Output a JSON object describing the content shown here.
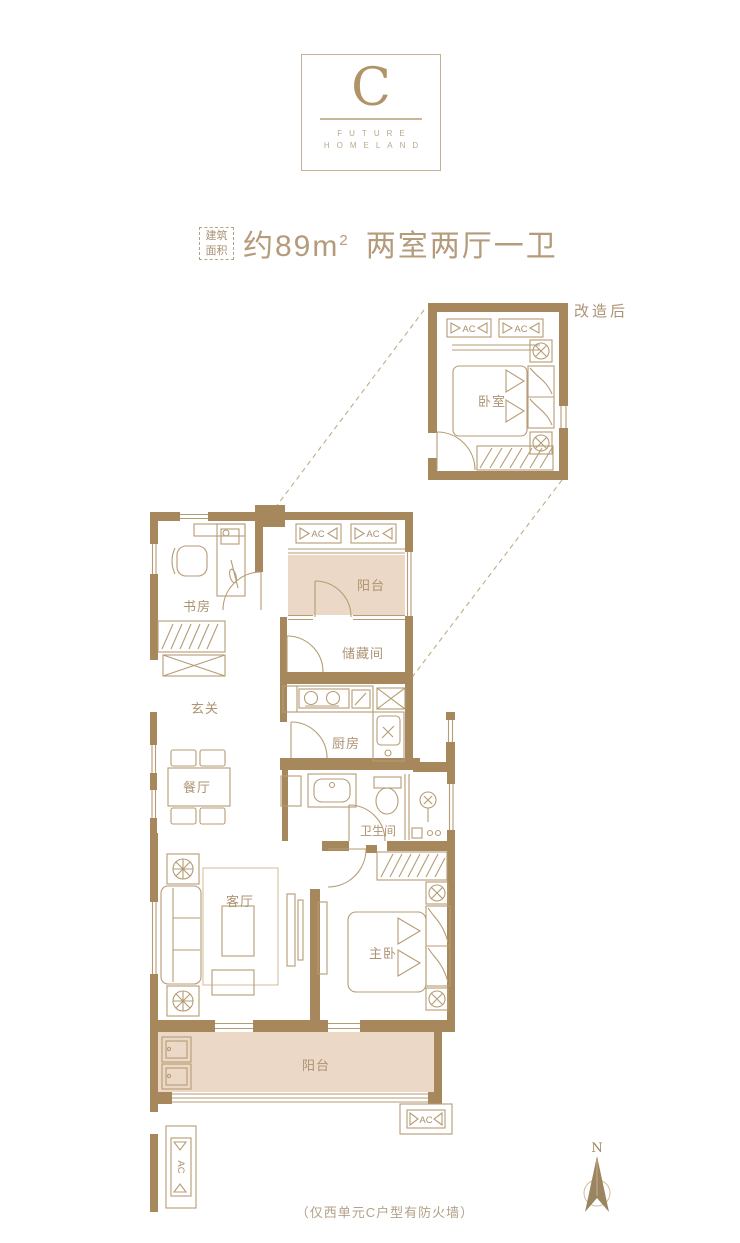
{
  "logo": {
    "letter": "C",
    "line1": "FUTURE",
    "line2": "HOMELAND"
  },
  "title": {
    "badge_line1": "建筑",
    "badge_line2": "面积",
    "area_prefix": "约89m",
    "area_sup": "2",
    "layout": "两室两厅一卫"
  },
  "plan": {
    "annotation_renovated": "改造后",
    "ac_label": "AC",
    "compass_north": "N",
    "footnote": "（仅西单元C户型有防火墙）",
    "rooms": {
      "detail_bedroom": "卧室",
      "study": "书房",
      "balcony_top": "阳台",
      "storage": "储藏间",
      "entry": "玄关",
      "kitchen": "厨房",
      "dining": "餐厅",
      "bathroom": "卫生间",
      "living": "客厅",
      "master_bedroom": "主卧",
      "balcony_bottom": "阳台"
    }
  },
  "colors": {
    "wall": "#a6885c",
    "furniture_line": "#b59c74",
    "balcony_fill": "#ecd8c6",
    "label_text": "#ad9372",
    "title_text": "#b49b7b"
  }
}
